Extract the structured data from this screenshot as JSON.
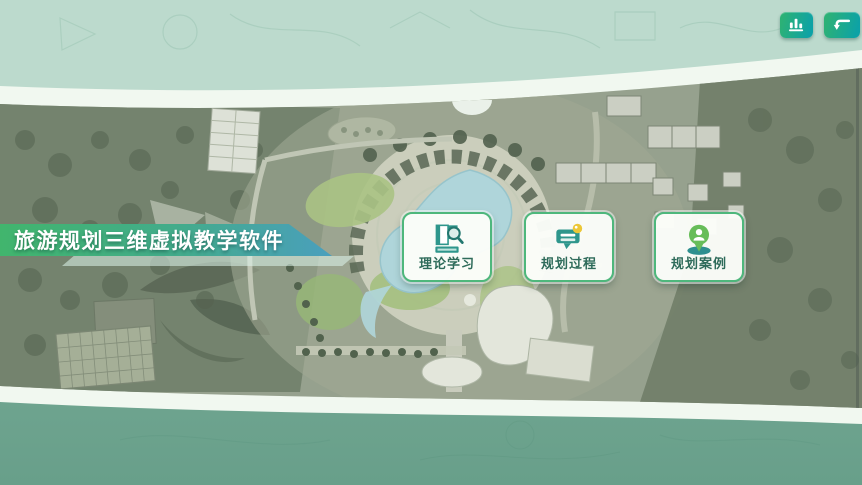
{
  "header": {
    "title": "旅游规划三维虚拟教学软件"
  },
  "topbar": {
    "buttons": [
      {
        "id": "statistics",
        "icon": "bar-chart-icon"
      },
      {
        "id": "return",
        "icon": "return-icon"
      }
    ]
  },
  "menu": {
    "items": [
      {
        "id": "theory-study",
        "label": "理论学习",
        "icon": "book-magnifier-icon"
      },
      {
        "id": "planning-process",
        "label": "规划过程",
        "icon": "presentation-bubble-icon"
      },
      {
        "id": "planning-case",
        "label": "规划案例",
        "icon": "person-pin-icon"
      }
    ]
  },
  "background": {
    "description": "aerial tourism master-plan map band with curved white edges",
    "colors": {
      "bg_top": "#bcdacd",
      "bg_bottom": "#79af9a",
      "band_white": "#f1f8f0",
      "map_base": "#8e9a84",
      "accent_green": "#3eb46d",
      "accent_teal": "#14a1a6",
      "banner_gradient_start": "#41b56d",
      "banner_gradient_end": "#4a9fbd",
      "card_border": "#4eb77c",
      "card_label": "#2e6b5a",
      "lake_blue": "#abd7de",
      "icon_yellow": "#ecc737"
    }
  }
}
